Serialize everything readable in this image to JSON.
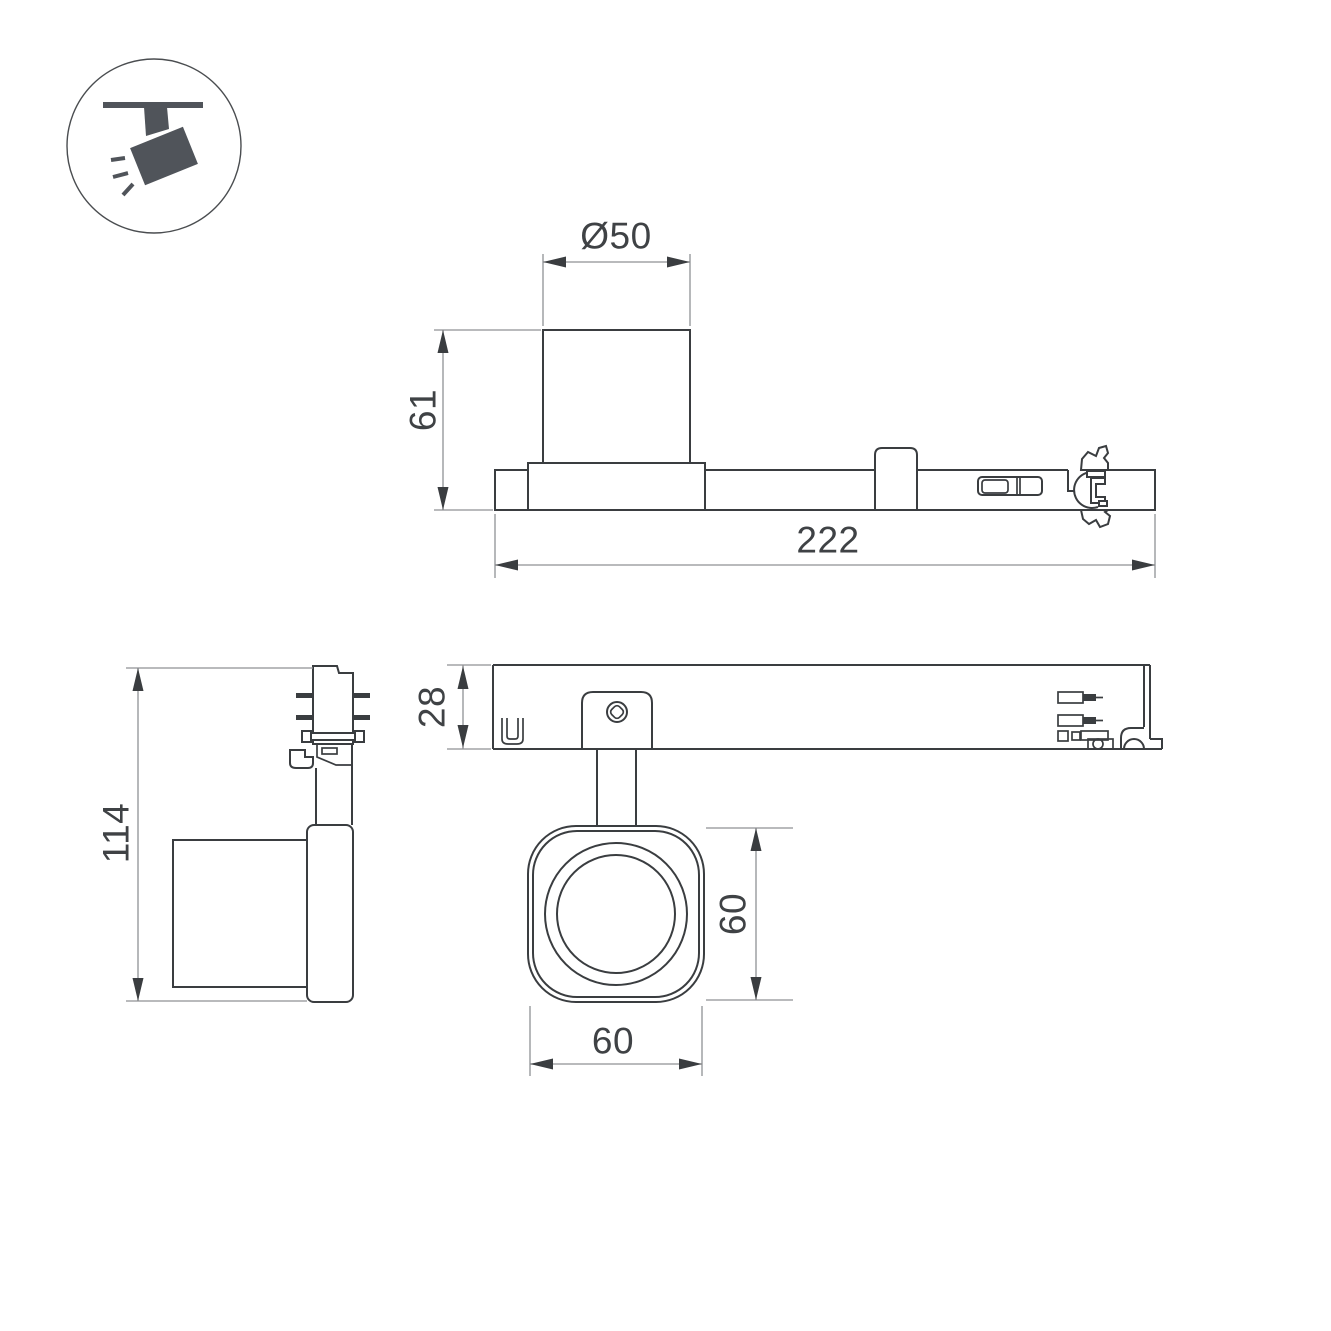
{
  "document": {
    "type": "technical-dimension-drawing",
    "background": "#ffffff"
  },
  "colors": {
    "outline": "#3a3d40",
    "dimension_line": "#8f9194",
    "label_text": "#3f4245",
    "icon_fill": "#50545a"
  },
  "icons": {
    "badge": "ceiling-track-spotlight-icon"
  },
  "dimensions": {
    "lamp_diameter": "Ø50",
    "lamp_height": "61",
    "track_length": "222",
    "overall_height": "114",
    "track_depth": "28",
    "head_height": "60",
    "head_width": "60"
  }
}
